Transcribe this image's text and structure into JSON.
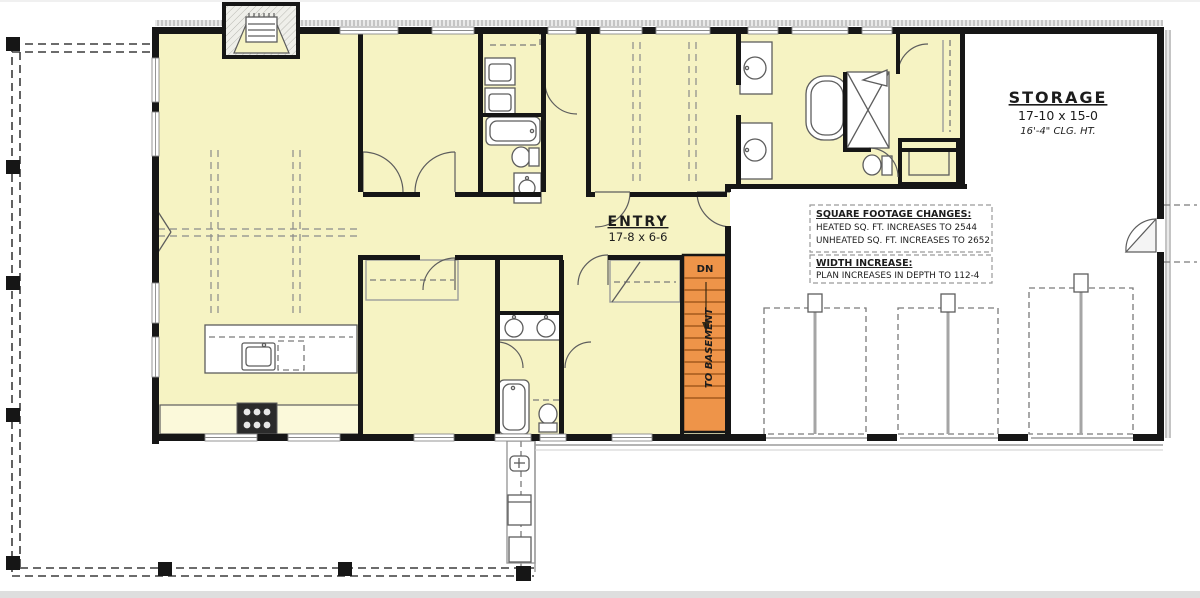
{
  "colors": {
    "room_fill": "#f6f3c3",
    "unheated_fill": "#ffffff",
    "wall": "#161616",
    "stair_fill": "#ee9449",
    "stair_tread": "#a35a1d",
    "fixture_line": "#5d5d5d",
    "paper_edge": "#dedede"
  },
  "rooms": {
    "storage": {
      "label": "STORAGE",
      "dimensions": "17-10 x 15-0",
      "ceiling_height": "16'-4\" CLG. HT."
    },
    "entry": {
      "label": "ENTRY",
      "dimensions": "17-8 x 6-6"
    }
  },
  "stairs": {
    "direction_label": "DN",
    "destination_label": "TO BASEMENT"
  },
  "notes": {
    "square_footage": {
      "title": "SQUARE FOOTAGE CHANGES:",
      "lines": [
        "HEATED SQ. FT. INCREASES TO 2544",
        "UNHEATED SQ. FT. INCREASES TO 2652"
      ]
    },
    "width_increase": {
      "title": "WIDTH INCREASE:",
      "lines": [
        "PLAN INCREASES IN DEPTH TO 112-4"
      ]
    }
  }
}
